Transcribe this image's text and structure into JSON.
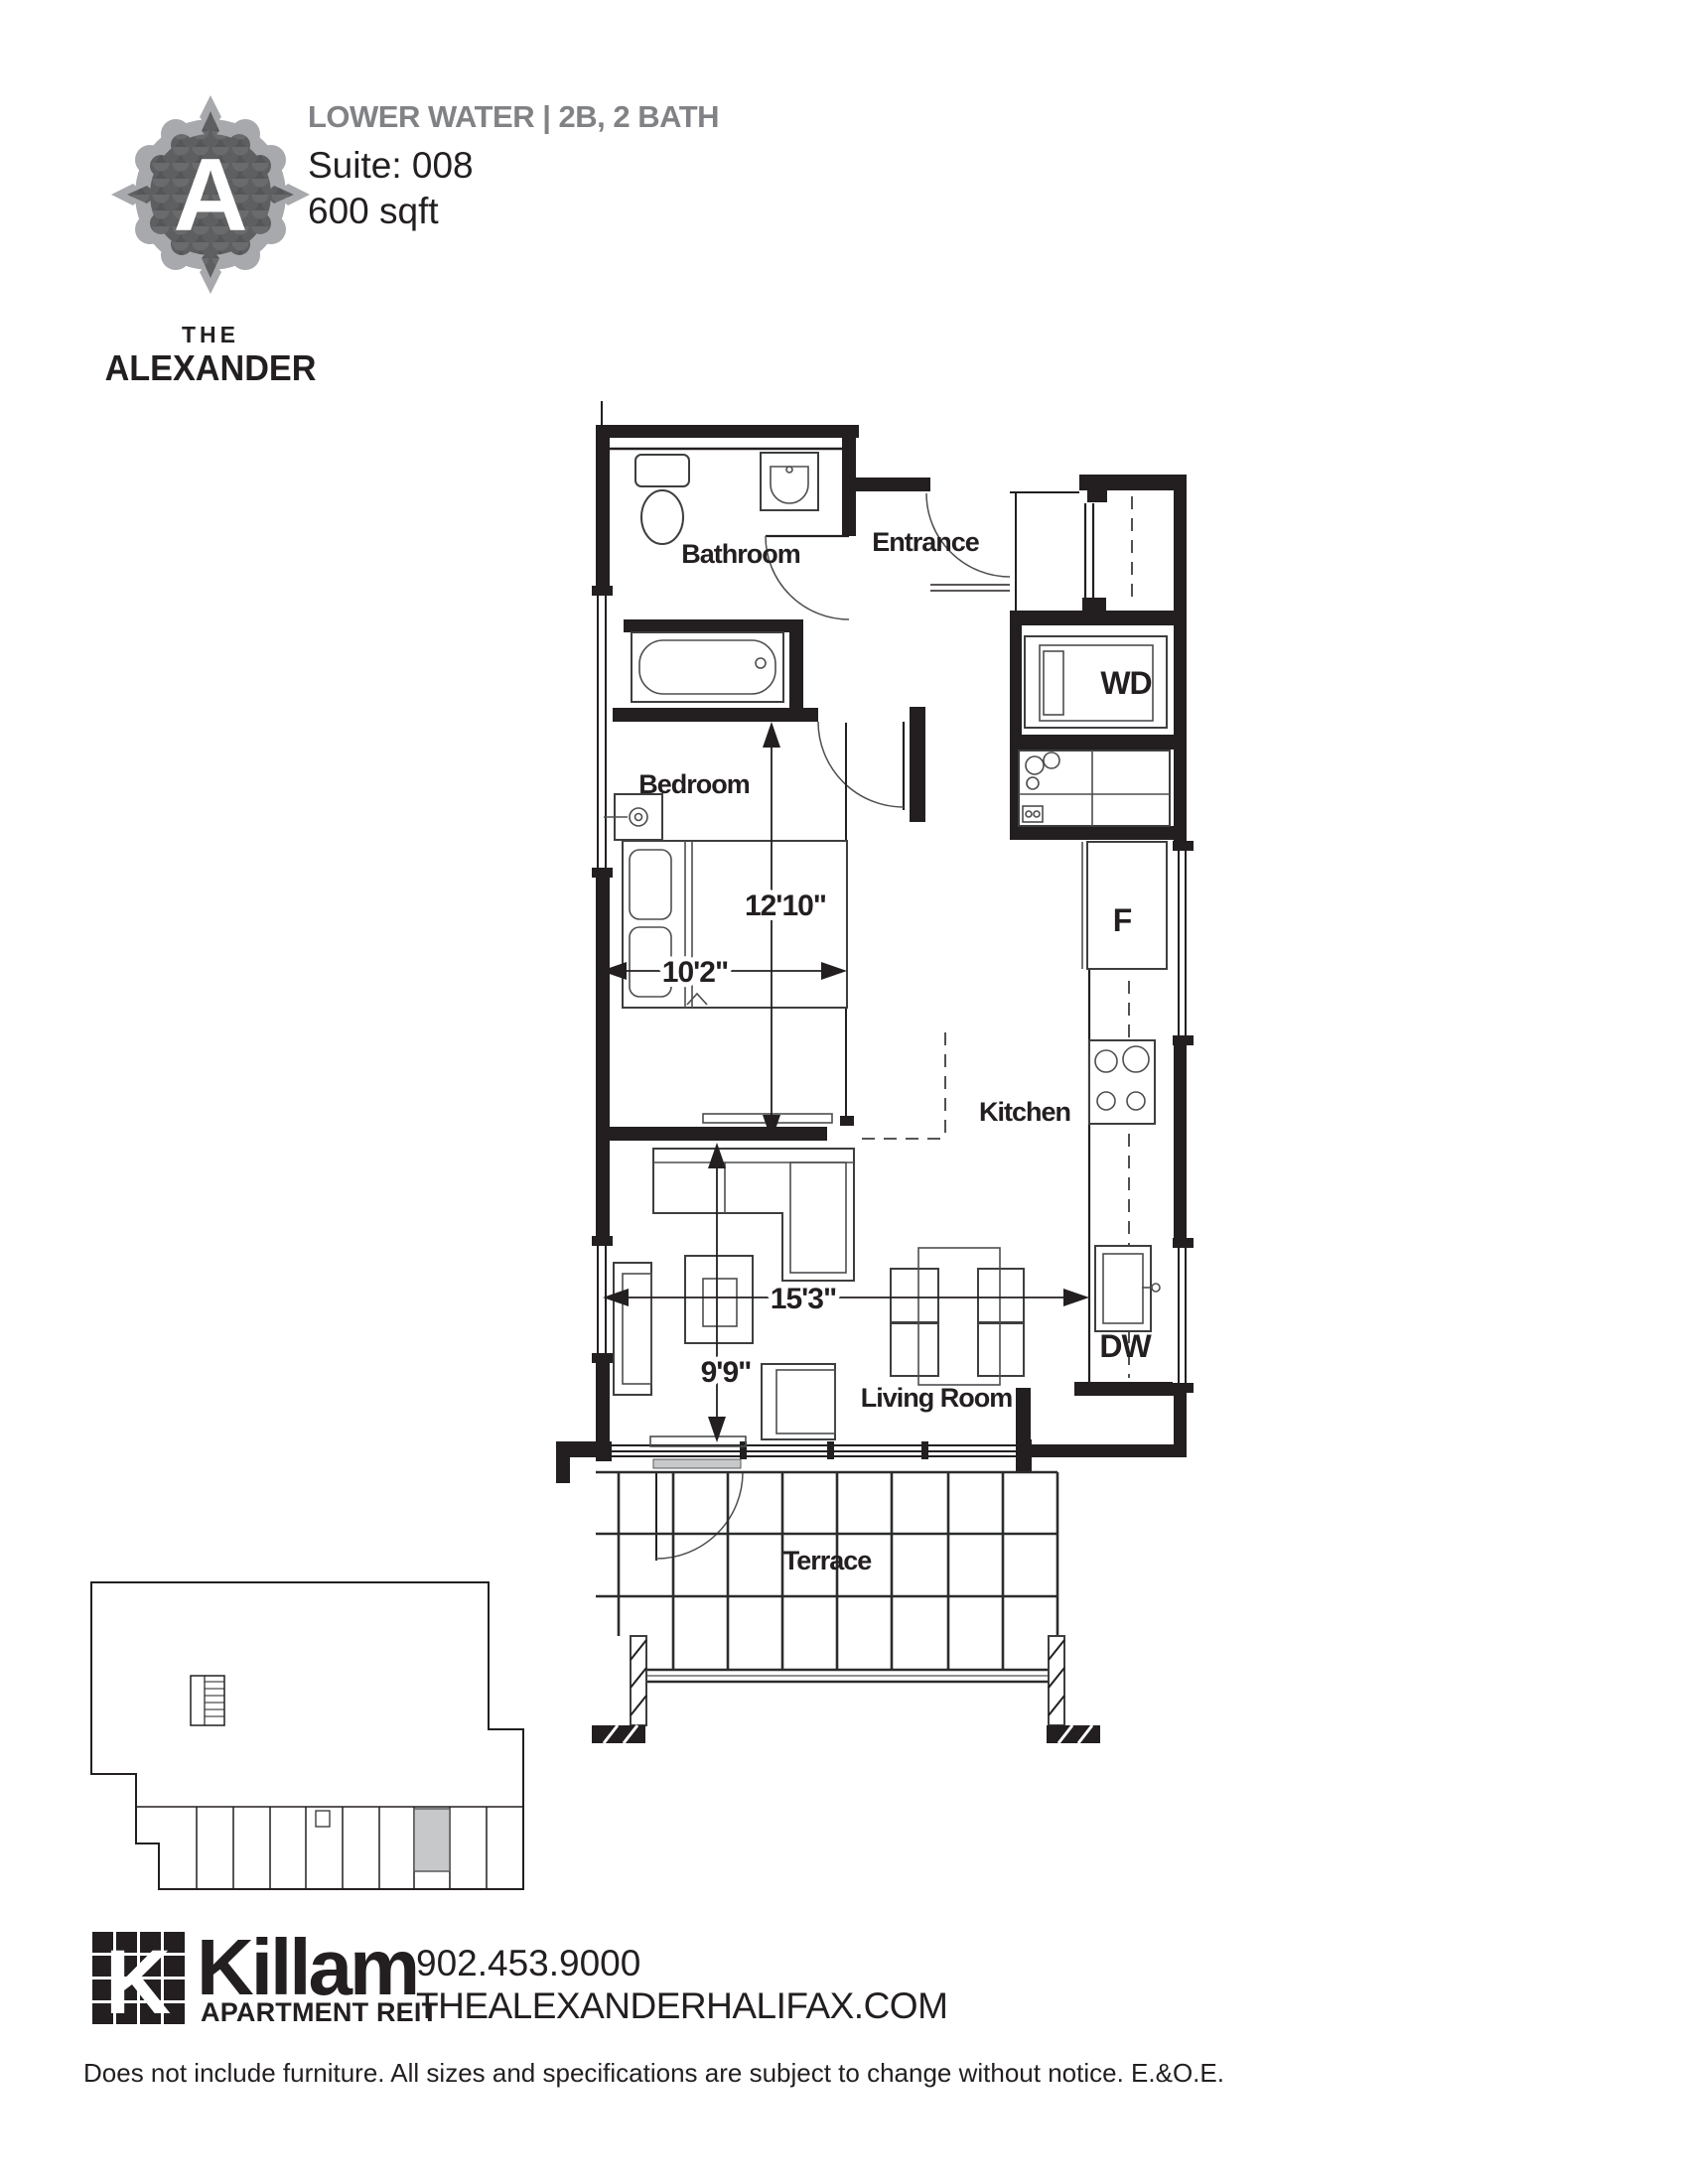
{
  "branding": {
    "logo_letter": "A",
    "logo_the": "THE",
    "logo_name": "ALEXANDER"
  },
  "header": {
    "plan_title": "LOWER WATER | 2B, 2 BATH",
    "suite": "Suite: 008",
    "area": "600 sqft"
  },
  "floorplan": {
    "rooms": {
      "bathroom": "Bathroom",
      "entrance": "Entrance",
      "bedroom": "Bedroom",
      "kitchen": "Kitchen",
      "living_room": "Living Room",
      "terrace": "Terrace"
    },
    "appliances": {
      "washer_dryer": "WD",
      "fridge": "F",
      "dishwasher": "DW"
    },
    "dimensions": {
      "bedroom_length": "12'10\"",
      "bedroom_width": "10'2\"",
      "living_length": "15'3\"",
      "living_width": "9'9\""
    }
  },
  "footer": {
    "brand_k": "K",
    "brand_name": "Killam",
    "brand_sub": "APARTMENT REIT",
    "phone": "902.453.9000",
    "website": "THEALEXANDERHALIFAX.COM",
    "disclaimer": "Does not include furniture. All sizes and specifications are subject to change without notice. E.&O.E."
  },
  "colors": {
    "ink": "#231f20",
    "title_gray": "#808285",
    "badge_ring": "#a7a9ac",
    "badge_fill": "#636466",
    "highlight_gray": "#c7c8ca"
  }
}
